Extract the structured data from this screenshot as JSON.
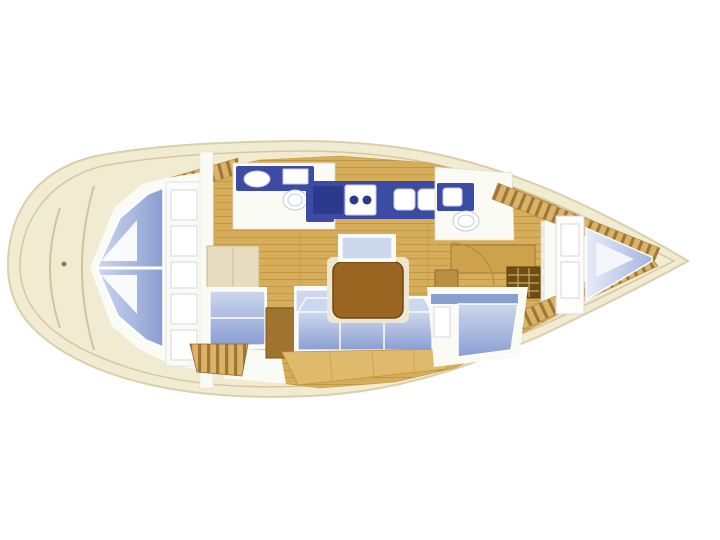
{
  "diagram": {
    "kind": "sailing-yacht-interior-floor-plan",
    "orientation": "bow-left-stern-right",
    "regions": [
      {
        "name": "anchor-locker"
      },
      {
        "name": "forward-cabin-v-berth"
      },
      {
        "name": "forward-head"
      },
      {
        "name": "salon-dinette"
      },
      {
        "name": "galley"
      },
      {
        "name": "nav-station"
      },
      {
        "name": "companionway-steps"
      },
      {
        "name": "aft-head"
      },
      {
        "name": "aft-cabin-double-berth"
      },
      {
        "name": "cockpit-teak-benches"
      },
      {
        "name": "stern-berth-area"
      }
    ]
  },
  "palette": {
    "bg": "#ffffff",
    "hull-fill": "#f1ebd2",
    "hull-line": "#d9cfab",
    "deck-line": "#cfc49c",
    "wood": "#d6ab57",
    "wood-line": "#c0953f",
    "wood-light": "#dfba6d",
    "wood-dark": "#a57a38",
    "slat-light": "#d8b368",
    "slat-dark": "#a27536",
    "royal": "#3c4ba4",
    "royal-dark": "#2c3a8e",
    "uph-light": "#ccd8ee",
    "uph-mid": "#a4b6e0",
    "uph-dark": "#8b9ed2",
    "white-room": "#fbfbf6",
    "table": "#9a6421",
    "table-dark": "#6f4511",
    "cream-cab": "#e8dcc0",
    "panel-brown": "#6f4e16",
    "fixture-line": "#c6cbd9"
  }
}
